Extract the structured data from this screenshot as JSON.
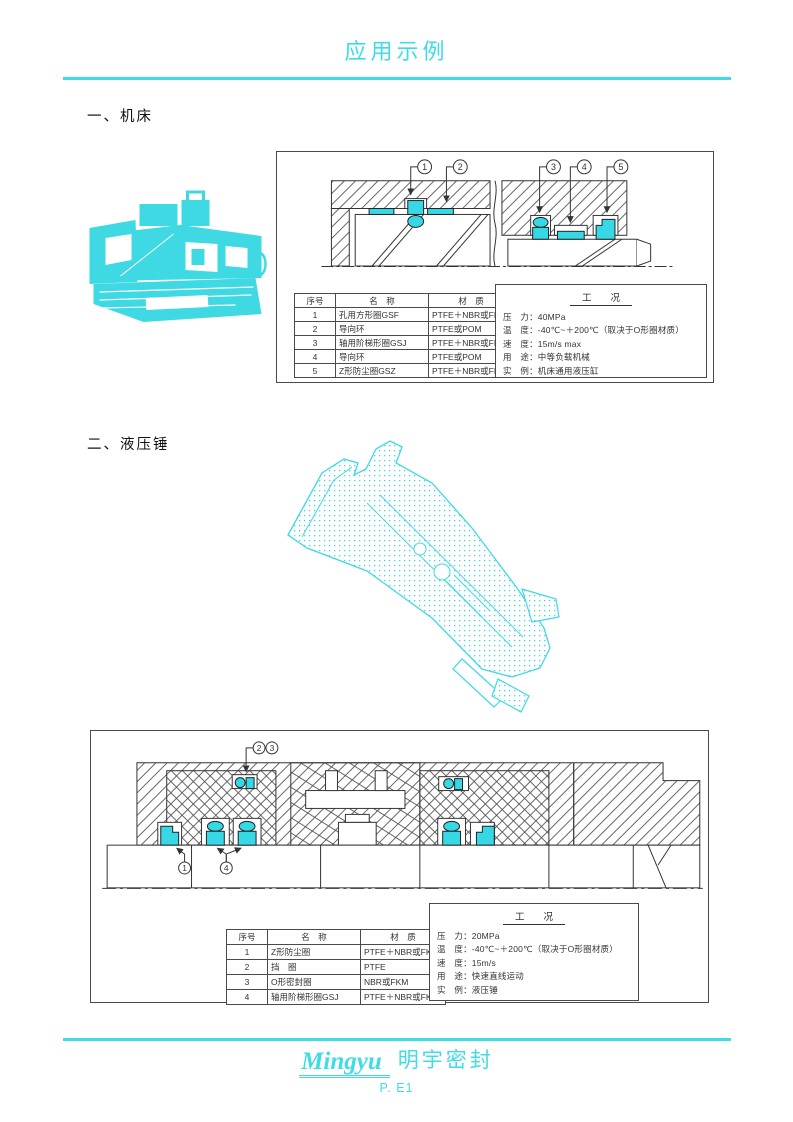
{
  "page": {
    "title": "应用示例",
    "accent_color": "#3FDCE7",
    "seal_color": "#35D8E4",
    "footer": {
      "brand_en": "Mingyu",
      "brand_cn": "明宇密封",
      "page_number": "P. E1"
    }
  },
  "sections": {
    "one": {
      "heading": "一、机床",
      "callouts": [
        "1",
        "2",
        "3",
        "4",
        "5"
      ],
      "table": {
        "col_no": "序号",
        "col_name": "名　称",
        "col_material": "材　质",
        "rows": [
          {
            "no": "1",
            "name": "孔用方形圈GSF",
            "material": "PTFE＋NBR或FKM"
          },
          {
            "no": "2",
            "name": "导向环",
            "material": "PTFE或POM"
          },
          {
            "no": "3",
            "name": "轴用阶梯形圈GSJ",
            "material": "PTFE＋NBR或FKM"
          },
          {
            "no": "4",
            "name": "导向环",
            "material": "PTFE或POM"
          },
          {
            "no": "5",
            "name": "Z形防尘圈GSZ",
            "material": "PTFE＋NBR或FKM"
          }
        ]
      },
      "conditions": {
        "title": "工　　况",
        "lines": [
          "压　力：40MPa",
          "温　度：-40℃~＋200℃（取决于O形圈材质）",
          "速　度：15m/s max",
          "用　途：中等负载机械",
          "实　例：机床通用液压缸"
        ]
      }
    },
    "two": {
      "heading": "二、液压锤",
      "callouts": [
        "1",
        "2",
        "3",
        "4"
      ],
      "table": {
        "col_no": "序号",
        "col_name": "名　称",
        "col_material": "材　质",
        "rows": [
          {
            "no": "1",
            "name": "Z形防尘圈",
            "material": "PTFE＋NBR或FKM"
          },
          {
            "no": "2",
            "name": "挡　圈",
            "material": "PTFE"
          },
          {
            "no": "3",
            "name": "O形密封圈",
            "material": "NBR或FKM"
          },
          {
            "no": "4",
            "name": "轴用阶梯形圈GSJ",
            "material": "PTFE＋NBR或FKM"
          }
        ]
      },
      "conditions": {
        "title": "工　　况",
        "lines": [
          "压　力：20MPa",
          "温　度：-40℃~＋200℃（取决于O形圈材质）",
          "速　度：15m/s",
          "用　途：快速直线运动",
          "实　例：液压锤"
        ]
      }
    }
  }
}
